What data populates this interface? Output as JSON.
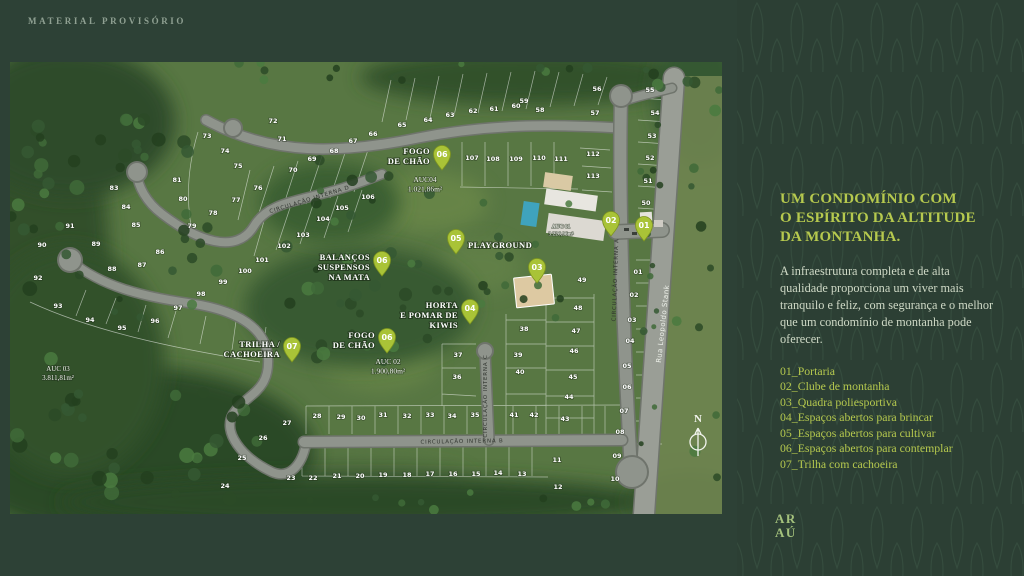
{
  "theme": {
    "background": "#2d4136",
    "accent": "#b6c94e",
    "pin_color": "#a9c337",
    "road_color": "#8f948c",
    "map_green": "#587743"
  },
  "watermark": "MATERIAL PROVISÓRIO",
  "panel": {
    "heading_lines": [
      "UM CONDOMÍNIO COM",
      "O ESPÍRITO DA ALTITUDE",
      "DA MONTANHA."
    ],
    "body": "A infraestrutura completa e de alta qualidade proporciona um viver mais tranquilo e feliz, com segurança e o melhor que um condomínio de montanha pode oferecer.",
    "legend": [
      "01_Portaria",
      "02_Clube de montanha",
      "03_Quadra poliesportiva",
      "04_Espaços abertos para brincar",
      "05_Espaços abertos para cultivar",
      "06_Espaços abertos para contemplar",
      "07_Trilha com cachoeira"
    ],
    "logo_lines": [
      "AR",
      "AÚ"
    ]
  },
  "map": {
    "north_label": "N",
    "street_label": "Rua Leopoldo Stank",
    "road_labels": [
      {
        "text": "CIRCULAÇÃO INTERNA A",
        "x": 607,
        "y": 218,
        "rot": -88
      },
      {
        "text": "CIRCULAÇÃO INTERNA B",
        "x": 452,
        "y": 381,
        "rot": -1
      },
      {
        "text": "CIRCULAÇÃO INTERNA C",
        "x": 477,
        "y": 334,
        "rot": -90
      },
      {
        "text": "CIRCULAÇÃO INTERNA D",
        "x": 300,
        "y": 139,
        "rot": -17
      }
    ],
    "auc_labels": [
      {
        "x": 415,
        "y": 120,
        "size": 7.5,
        "lines": [
          "AUC04",
          "1.021,86m²"
        ]
      },
      {
        "x": 378,
        "y": 302,
        "size": 7.5,
        "lines": [
          "AUC 02",
          "1.900,80m²"
        ]
      },
      {
        "x": 48,
        "y": 309,
        "size": 7,
        "lines": [
          "AUC 03",
          "3.811,81m²"
        ]
      },
      {
        "x": 551,
        "y": 166,
        "size": 5.5,
        "lines": [
          "AUC 01",
          "3.226,96m²"
        ]
      }
    ],
    "amenities": [
      {
        "pin": "06",
        "px": 432,
        "py": 108,
        "lines": [
          "FOGO",
          "DE CHÃO"
        ],
        "tx": 420,
        "ty": 92,
        "anchor": "end"
      },
      {
        "pin": "05",
        "px": 446,
        "py": 192,
        "lines": [
          "PLAYGROUND"
        ],
        "tx": 458,
        "ty": 186,
        "anchor": "start"
      },
      {
        "pin": "06",
        "px": 372,
        "py": 214,
        "lines": [
          "BALANÇOS",
          "SUSPENSOS",
          "NA MATA"
        ],
        "tx": 360,
        "ty": 198,
        "anchor": "end"
      },
      {
        "pin": "04",
        "px": 460,
        "py": 262,
        "lines": [
          "HORTA",
          "E POMAR DE",
          "KIWIS"
        ],
        "tx": 448,
        "ty": 246,
        "anchor": "end"
      },
      {
        "pin": "06",
        "px": 377,
        "py": 291,
        "lines": [
          "FOGO",
          "DE CHÃO"
        ],
        "tx": 365,
        "ty": 276,
        "anchor": "end"
      },
      {
        "pin": "07",
        "px": 282,
        "py": 300,
        "lines": [
          "TRILHA /",
          "CACHOEIRA"
        ],
        "tx": 270,
        "ty": 285,
        "anchor": "end"
      },
      {
        "pin": "03",
        "px": 527,
        "py": 221,
        "lines": [],
        "tx": 0,
        "ty": 0,
        "anchor": "end"
      },
      {
        "pin": "02",
        "px": 601,
        "py": 174,
        "lines": [],
        "tx": 0,
        "ty": 0,
        "anchor": "end"
      },
      {
        "pin": "01",
        "px": 634,
        "py": 179,
        "lines": [],
        "tx": 0,
        "ty": 0,
        "anchor": "end"
      }
    ],
    "lots": [
      {
        "n": "01",
        "x": 628,
        "y": 212
      },
      {
        "n": "02",
        "x": 624,
        "y": 235
      },
      {
        "n": "03",
        "x": 622,
        "y": 260
      },
      {
        "n": "04",
        "x": 620,
        "y": 281
      },
      {
        "n": "05",
        "x": 617,
        "y": 306
      },
      {
        "n": "06",
        "x": 617,
        "y": 327
      },
      {
        "n": "07",
        "x": 614,
        "y": 351
      },
      {
        "n": "08",
        "x": 610,
        "y": 372
      },
      {
        "n": "09",
        "x": 607,
        "y": 396
      },
      {
        "n": "10",
        "x": 605,
        "y": 419
      },
      {
        "n": "11",
        "x": 547,
        "y": 400
      },
      {
        "n": "12",
        "x": 548,
        "y": 427
      },
      {
        "n": "13",
        "x": 512,
        "y": 414
      },
      {
        "n": "14",
        "x": 488,
        "y": 413
      },
      {
        "n": "15",
        "x": 466,
        "y": 414
      },
      {
        "n": "16",
        "x": 443,
        "y": 414
      },
      {
        "n": "17",
        "x": 420,
        "y": 414
      },
      {
        "n": "18",
        "x": 397,
        "y": 415
      },
      {
        "n": "19",
        "x": 373,
        "y": 415
      },
      {
        "n": "20",
        "x": 350,
        "y": 416
      },
      {
        "n": "21",
        "x": 327,
        "y": 416
      },
      {
        "n": "22",
        "x": 303,
        "y": 418
      },
      {
        "n": "23",
        "x": 281,
        "y": 418
      },
      {
        "n": "24",
        "x": 215,
        "y": 426
      },
      {
        "n": "25",
        "x": 232,
        "y": 398
      },
      {
        "n": "26",
        "x": 253,
        "y": 378
      },
      {
        "n": "27",
        "x": 277,
        "y": 363
      },
      {
        "n": "28",
        "x": 307,
        "y": 356
      },
      {
        "n": "29",
        "x": 331,
        "y": 357
      },
      {
        "n": "30",
        "x": 351,
        "y": 358
      },
      {
        "n": "31",
        "x": 373,
        "y": 355
      },
      {
        "n": "32",
        "x": 397,
        "y": 356
      },
      {
        "n": "33",
        "x": 420,
        "y": 355
      },
      {
        "n": "34",
        "x": 442,
        "y": 356
      },
      {
        "n": "35",
        "x": 465,
        "y": 355
      },
      {
        "n": "36",
        "x": 447,
        "y": 317
      },
      {
        "n": "37",
        "x": 448,
        "y": 295
      },
      {
        "n": "38",
        "x": 514,
        "y": 269
      },
      {
        "n": "39",
        "x": 508,
        "y": 295
      },
      {
        "n": "40",
        "x": 510,
        "y": 312
      },
      {
        "n": "41",
        "x": 504,
        "y": 355
      },
      {
        "n": "42",
        "x": 524,
        "y": 355
      },
      {
        "n": "43",
        "x": 555,
        "y": 359
      },
      {
        "n": "44",
        "x": 559,
        "y": 337
      },
      {
        "n": "45",
        "x": 563,
        "y": 317
      },
      {
        "n": "46",
        "x": 564,
        "y": 291
      },
      {
        "n": "47",
        "x": 566,
        "y": 271
      },
      {
        "n": "48",
        "x": 568,
        "y": 248
      },
      {
        "n": "49",
        "x": 572,
        "y": 220
      },
      {
        "n": "50",
        "x": 636,
        "y": 143
      },
      {
        "n": "51",
        "x": 638,
        "y": 121
      },
      {
        "n": "52",
        "x": 640,
        "y": 98
      },
      {
        "n": "53",
        "x": 642,
        "y": 76
      },
      {
        "n": "54",
        "x": 645,
        "y": 53
      },
      {
        "n": "55",
        "x": 640,
        "y": 30
      },
      {
        "n": "56",
        "x": 587,
        "y": 29
      },
      {
        "n": "57",
        "x": 585,
        "y": 53
      },
      {
        "n": "58",
        "x": 530,
        "y": 50
      },
      {
        "n": "59",
        "x": 514,
        "y": 41
      },
      {
        "n": "60",
        "x": 506,
        "y": 46
      },
      {
        "n": "61",
        "x": 484,
        "y": 49
      },
      {
        "n": "62",
        "x": 463,
        "y": 51
      },
      {
        "n": "63",
        "x": 440,
        "y": 55
      },
      {
        "n": "64",
        "x": 418,
        "y": 60
      },
      {
        "n": "65",
        "x": 392,
        "y": 65
      },
      {
        "n": "66",
        "x": 363,
        "y": 74
      },
      {
        "n": "67",
        "x": 343,
        "y": 81
      },
      {
        "n": "68",
        "x": 324,
        "y": 91
      },
      {
        "n": "69",
        "x": 302,
        "y": 99
      },
      {
        "n": "70",
        "x": 283,
        "y": 110
      },
      {
        "n": "71",
        "x": 272,
        "y": 79
      },
      {
        "n": "72",
        "x": 263,
        "y": 61
      },
      {
        "n": "73",
        "x": 197,
        "y": 76
      },
      {
        "n": "74",
        "x": 215,
        "y": 91
      },
      {
        "n": "75",
        "x": 228,
        "y": 106
      },
      {
        "n": "76",
        "x": 248,
        "y": 128
      },
      {
        "n": "77",
        "x": 226,
        "y": 140
      },
      {
        "n": "78",
        "x": 203,
        "y": 153
      },
      {
        "n": "79",
        "x": 182,
        "y": 166
      },
      {
        "n": "80",
        "x": 173,
        "y": 139
      },
      {
        "n": "81",
        "x": 167,
        "y": 120
      },
      {
        "n": "83",
        "x": 104,
        "y": 128
      },
      {
        "n": "84",
        "x": 116,
        "y": 147
      },
      {
        "n": "85",
        "x": 126,
        "y": 165
      },
      {
        "n": "86",
        "x": 150,
        "y": 192
      },
      {
        "n": "87",
        "x": 132,
        "y": 205
      },
      {
        "n": "88",
        "x": 102,
        "y": 209
      },
      {
        "n": "89",
        "x": 86,
        "y": 184
      },
      {
        "n": "90",
        "x": 32,
        "y": 185
      },
      {
        "n": "91",
        "x": 60,
        "y": 166
      },
      {
        "n": "92",
        "x": 28,
        "y": 218
      },
      {
        "n": "93",
        "x": 48,
        "y": 246
      },
      {
        "n": "94",
        "x": 80,
        "y": 260
      },
      {
        "n": "95",
        "x": 112,
        "y": 268
      },
      {
        "n": "96",
        "x": 145,
        "y": 261
      },
      {
        "n": "97",
        "x": 168,
        "y": 248
      },
      {
        "n": "98",
        "x": 191,
        "y": 234
      },
      {
        "n": "99",
        "x": 213,
        "y": 222
      },
      {
        "n": "100",
        "x": 235,
        "y": 211
      },
      {
        "n": "101",
        "x": 252,
        "y": 200
      },
      {
        "n": "102",
        "x": 274,
        "y": 186
      },
      {
        "n": "103",
        "x": 293,
        "y": 175
      },
      {
        "n": "104",
        "x": 313,
        "y": 159
      },
      {
        "n": "105",
        "x": 332,
        "y": 148
      },
      {
        "n": "106",
        "x": 358,
        "y": 137
      },
      {
        "n": "107",
        "x": 462,
        "y": 98
      },
      {
        "n": "108",
        "x": 483,
        "y": 99
      },
      {
        "n": "109",
        "x": 506,
        "y": 99
      },
      {
        "n": "110",
        "x": 529,
        "y": 98
      },
      {
        "n": "111",
        "x": 551,
        "y": 99
      },
      {
        "n": "112",
        "x": 583,
        "y": 94
      },
      {
        "n": "113",
        "x": 583,
        "y": 116
      }
    ]
  }
}
